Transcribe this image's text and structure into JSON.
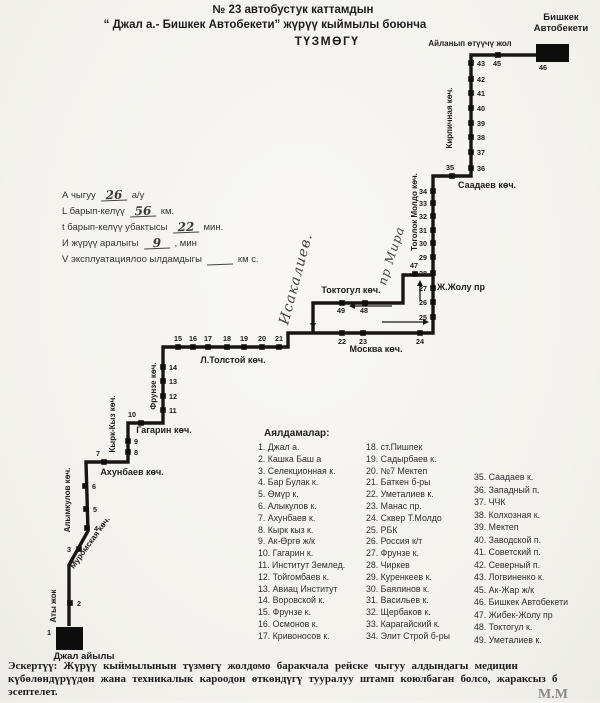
{
  "title": {
    "line1": "№ 23  автобустук каттамдын",
    "line2": "“ Джал а.- Бишкек Автобекети” жүрүү кыймылы боюнча",
    "line3": "ТҮЗМӨГҮ"
  },
  "params": {
    "rows": [
      {
        "label": "А чыгуу",
        "value": "26",
        "unit": "а/у"
      },
      {
        "label": "L барып-келүү",
        "value": "56",
        "unit": "км."
      },
      {
        "label": "t барып-келүү убактысы",
        "value": "22",
        "unit": "мин."
      },
      {
        "label": "И жүрүү аралыгы",
        "value": "9",
        "unit": ", мин"
      },
      {
        "label": "V эксплуатациялоо ылдамдыгы",
        "value": "",
        "unit": "км с."
      }
    ]
  },
  "map": {
    "line_color": "#181512",
    "routes": [
      [
        [
          69,
          626
        ],
        [
          69,
          565
        ],
        [
          88,
          531
        ],
        [
          86,
          462
        ],
        [
          128,
          462
        ],
        [
          128,
          423
        ],
        [
          163,
          423
        ],
        [
          163,
          347
        ],
        [
          288,
          347
        ],
        [
          288,
          333
        ],
        [
          433,
          333
        ],
        [
          433,
          176
        ],
        [
          471,
          176
        ],
        [
          471,
          55
        ],
        [
          537,
          55
        ]
      ],
      [
        [
          313,
          333
        ],
        [
          313,
          303
        ],
        [
          403,
          303
        ],
        [
          403,
          275
        ],
        [
          433,
          275
        ]
      ]
    ],
    "terminals": [
      {
        "name": "bishkek-terminal",
        "x": 536,
        "y": 44,
        "w": 33,
        "h": 18,
        "label_lines": [
          "Бишкек",
          "Автобекети"
        ],
        "lx": 561,
        "ly": 20,
        "dy": 11
      },
      {
        "name": "jal-terminal",
        "x": 56,
        "y": 627,
        "w": 27,
        "h": 23,
        "label_lines": [
          "Джал айылы"
        ],
        "lx": 84,
        "ly": 659,
        "dy": 11
      }
    ],
    "streets": [
      {
        "text": "Айланып өтүүчү жол",
        "x": 470,
        "y": 46,
        "rot": 0,
        "size": 8,
        "hand": false
      },
      {
        "text": "Кирпичная көч.",
        "x": 452,
        "y": 118,
        "rot": -90,
        "size": 8,
        "hand": false
      },
      {
        "text": "Саадаев көч.",
        "x": 487,
        "y": 188,
        "rot": 0,
        "size": 9,
        "hand": false
      },
      {
        "text": "Тоголок Молдо көч.",
        "x": 417,
        "y": 212,
        "rot": -90,
        "size": 8,
        "hand": false
      },
      {
        "text": "пр Мира",
        "x": 395,
        "y": 257,
        "rot": -72,
        "size": 12,
        "hand": true
      },
      {
        "text": "Исакалиев.",
        "x": 300,
        "y": 280,
        "rot": -75,
        "size": 14,
        "hand": true
      },
      {
        "text": "Ж.Жолу пр",
        "x": 461,
        "y": 290,
        "rot": 0,
        "size": 9,
        "hand": false
      },
      {
        "text": "Токтогул көч.",
        "x": 351,
        "y": 293,
        "rot": 0,
        "size": 9,
        "hand": false
      },
      {
        "text": "Москва көч.",
        "x": 376,
        "y": 352,
        "rot": 0,
        "size": 9,
        "hand": false
      },
      {
        "text": "Л.Толстой көч.",
        "x": 233,
        "y": 363,
        "rot": 0,
        "size": 9,
        "hand": false
      },
      {
        "text": "Фрунзе көч.",
        "x": 156,
        "y": 386,
        "rot": -90,
        "size": 8,
        "hand": false
      },
      {
        "text": "Гагарин көч.",
        "x": 164,
        "y": 433,
        "rot": 0,
        "size": 9,
        "hand": false
      },
      {
        "text": "Кырк-Кыз көч.",
        "x": 115,
        "y": 424,
        "rot": -90,
        "size": 8,
        "hand": false
      },
      {
        "text": "Ахунбаев көч.",
        "x": 132,
        "y": 475,
        "rot": 0,
        "size": 9,
        "hand": false
      },
      {
        "text": "Алымкулов көч.",
        "x": 70,
        "y": 500,
        "rot": -90,
        "size": 8,
        "hand": false
      },
      {
        "text": "Муромская көч.",
        "x": 92,
        "y": 544,
        "rot": -54,
        "size": 8,
        "hand": false
      },
      {
        "text": "Аты жок",
        "x": 56,
        "y": 606,
        "rot": -90,
        "size": 8,
        "hand": false
      }
    ],
    "stops": [
      {
        "n": "1",
        "x": 52,
        "y": 632,
        "lx": 49,
        "ly": 635,
        "a": "middle",
        "t": 0
      },
      {
        "n": "2",
        "x": 70,
        "y": 603,
        "lx": 77,
        "ly": 606,
        "a": "start",
        "t": 1
      },
      {
        "n": "3",
        "x": 79,
        "y": 549,
        "lx": 71,
        "ly": 552,
        "a": "end",
        "t": 1
      },
      {
        "n": "4",
        "x": 87,
        "y": 528,
        "lx": 94,
        "ly": 531,
        "a": "start",
        "t": 1
      },
      {
        "n": "5",
        "x": 86,
        "y": 509,
        "lx": 93,
        "ly": 512,
        "a": "start",
        "t": 1
      },
      {
        "n": "6",
        "x": 85,
        "y": 486,
        "lx": 92,
        "ly": 489,
        "a": "start",
        "t": 1
      },
      {
        "n": "7",
        "x": 104,
        "y": 462,
        "lx": 100,
        "ly": 456,
        "a": "end",
        "t": 1
      },
      {
        "n": "8",
        "x": 128,
        "y": 452,
        "lx": 134,
        "ly": 455,
        "a": "start",
        "t": 1
      },
      {
        "n": "9",
        "x": 128,
        "y": 441,
        "lx": 134,
        "ly": 444,
        "a": "start",
        "t": 1
      },
      {
        "n": "10",
        "x": 141,
        "y": 423,
        "lx": 136,
        "ly": 417,
        "a": "end",
        "t": 1
      },
      {
        "n": "11",
        "x": 163,
        "y": 410,
        "lx": 169,
        "ly": 413,
        "a": "start",
        "t": 1
      },
      {
        "n": "12",
        "x": 163,
        "y": 396,
        "lx": 169,
        "ly": 399,
        "a": "start",
        "t": 1
      },
      {
        "n": "13",
        "x": 163,
        "y": 381,
        "lx": 169,
        "ly": 384,
        "a": "start",
        "t": 1
      },
      {
        "n": "14",
        "x": 163,
        "y": 367,
        "lx": 169,
        "ly": 370,
        "a": "start",
        "t": 1
      },
      {
        "n": "15",
        "x": 178,
        "y": 347,
        "lx": 178,
        "ly": 341,
        "a": "middle",
        "t": 1
      },
      {
        "n": "16",
        "x": 193,
        "y": 347,
        "lx": 193,
        "ly": 341,
        "a": "middle",
        "t": 1
      },
      {
        "n": "17",
        "x": 208,
        "y": 347,
        "lx": 208,
        "ly": 341,
        "a": "middle",
        "t": 1
      },
      {
        "n": "18",
        "x": 227,
        "y": 347,
        "lx": 227,
        "ly": 341,
        "a": "middle",
        "t": 1
      },
      {
        "n": "19",
        "x": 244,
        "y": 347,
        "lx": 244,
        "ly": 341,
        "a": "middle",
        "t": 1
      },
      {
        "n": "20",
        "x": 262,
        "y": 347,
        "lx": 262,
        "ly": 341,
        "a": "middle",
        "t": 1
      },
      {
        "n": "21",
        "x": 279,
        "y": 347,
        "lx": 279,
        "ly": 341,
        "a": "middle",
        "t": 1
      },
      {
        "n": "22",
        "x": 342,
        "y": 333,
        "lx": 342,
        "ly": 344,
        "a": "middle",
        "t": 1
      },
      {
        "n": "23",
        "x": 363,
        "y": 333,
        "lx": 363,
        "ly": 344,
        "a": "middle",
        "t": 1
      },
      {
        "n": "24",
        "x": 420,
        "y": 333,
        "lx": 420,
        "ly": 344,
        "a": "middle",
        "t": 1
      },
      {
        "n": "25",
        "x": 433,
        "y": 317,
        "lx": 427,
        "ly": 320,
        "a": "end",
        "t": 1
      },
      {
        "n": "26",
        "x": 433,
        "y": 302,
        "lx": 427,
        "ly": 305,
        "a": "end",
        "t": 1
      },
      {
        "n": "27",
        "x": 433,
        "y": 288,
        "lx": 427,
        "ly": 291,
        "a": "end",
        "t": 1
      },
      {
        "n": "28",
        "x": 433,
        "y": 273,
        "lx": 427,
        "ly": 276,
        "a": "end",
        "t": 1
      },
      {
        "n": "29",
        "x": 433,
        "y": 257,
        "lx": 427,
        "ly": 260,
        "a": "end",
        "t": 1
      },
      {
        "n": "30",
        "x": 433,
        "y": 243,
        "lx": 427,
        "ly": 246,
        "a": "end",
        "t": 1
      },
      {
        "n": "31",
        "x": 433,
        "y": 230,
        "lx": 427,
        "ly": 233,
        "a": "end",
        "t": 1
      },
      {
        "n": "32",
        "x": 433,
        "y": 216,
        "lx": 427,
        "ly": 219,
        "a": "end",
        "t": 1
      },
      {
        "n": "33",
        "x": 433,
        "y": 203,
        "lx": 427,
        "ly": 206,
        "a": "end",
        "t": 1
      },
      {
        "n": "34",
        "x": 433,
        "y": 191,
        "lx": 427,
        "ly": 194,
        "a": "end",
        "t": 1
      },
      {
        "n": "35",
        "x": 452,
        "y": 176,
        "lx": 450,
        "ly": 170,
        "a": "middle",
        "t": 1
      },
      {
        "n": "36",
        "x": 471,
        "y": 168,
        "lx": 477,
        "ly": 171,
        "a": "start",
        "t": 1
      },
      {
        "n": "37",
        "x": 471,
        "y": 152,
        "lx": 477,
        "ly": 155,
        "a": "start",
        "t": 1
      },
      {
        "n": "38",
        "x": 471,
        "y": 137,
        "lx": 477,
        "ly": 140,
        "a": "start",
        "t": 1
      },
      {
        "n": "39",
        "x": 471,
        "y": 123,
        "lx": 477,
        "ly": 126,
        "a": "start",
        "t": 1
      },
      {
        "n": "40",
        "x": 471,
        "y": 108,
        "lx": 477,
        "ly": 111,
        "a": "start",
        "t": 1
      },
      {
        "n": "41",
        "x": 471,
        "y": 93,
        "lx": 477,
        "ly": 96,
        "a": "start",
        "t": 1
      },
      {
        "n": "42",
        "x": 471,
        "y": 79,
        "lx": 477,
        "ly": 82,
        "a": "start",
        "t": 1
      },
      {
        "n": "43",
        "x": 471,
        "y": 63,
        "lx": 477,
        "ly": 66,
        "a": "start",
        "t": 1
      },
      {
        "n": "45",
        "x": 498,
        "y": 55,
        "lx": 497,
        "ly": 66,
        "a": "middle",
        "t": 1
      },
      {
        "n": "46",
        "x": 536,
        "y": 58,
        "lx": 543,
        "ly": 70,
        "a": "middle",
        "t": 0
      },
      {
        "n": "47",
        "x": 415,
        "y": 274,
        "lx": 414,
        "ly": 268,
        "a": "middle",
        "t": 1
      },
      {
        "n": "48",
        "x": 365,
        "y": 303,
        "lx": 364,
        "ly": 313,
        "a": "middle",
        "t": 1
      },
      {
        "n": "49",
        "x": 342,
        "y": 303,
        "lx": 341,
        "ly": 313,
        "a": "middle",
        "t": 1
      }
    ],
    "arrows": [
      {
        "x1": 392,
        "y1": 306,
        "x2": 349,
        "y2": 306
      },
      {
        "x1": 420,
        "y1": 301,
        "x2": 420,
        "y2": 280
      },
      {
        "x1": 382,
        "y1": 322,
        "x2": 429,
        "y2": 322
      },
      {
        "x1": 313,
        "y1": 307,
        "x2": 313,
        "y2": 329
      }
    ]
  },
  "legend": {
    "header": "Аялдамалар:",
    "col1": [
      "1. Джал а.",
      "2. Кашка Баш а",
      "3. Селекционная к.",
      "4. Бар Булак к.",
      "5. Өмүр к.",
      "6. Алыкулов к.",
      "7. Ахунбаев к.",
      "8. Кырк кыз к.",
      "9. Ак-Өргө ж/к",
      "10. Гагарин к.",
      "11. Институт Землед.",
      "12. Тойгомбаев к.",
      "13. Авиац Институт",
      "14. Воровской к.",
      "15. Фрунзе к.",
      "16. Осмонов к.",
      "17. Кривоносов к."
    ],
    "col2": [
      "18. ст.Пишпек",
      "19. Садырбаев к.",
      "20. №7 Мектеп",
      "21. Баткен б-ры",
      "22. Уметалиев к.",
      "23. Манас пр.",
      "24. Сквер Т.Молдо",
      "25. РБК",
      "26. Россия к/т",
      "27. Фрунзе к.",
      "28. Чиркев",
      "29. Куренкеев к.",
      "30. Баялинов к.",
      "31. Васильев к.",
      "32. Щербаков к.",
      "33. Карагайский к.",
      "34. Элит Строй б-ры"
    ],
    "col3": [
      "35. Саадаев к.",
      "36. Западный п.",
      "37. ЧЧК",
      "38. Колхозная к.",
      "39. Мектеп",
      "40. Заводской п.",
      "41. Советский п.",
      "42. Северный п.",
      "43. Логвиненко к.",
      "45. Ак-Жар ж/к",
      "46. Бишкек Автобекети",
      "47. Жибек-Жолу пр",
      "48. Токтогул к.",
      "49. Уметалиев к."
    ]
  },
  "note": {
    "prefix": "Эскертүү:",
    "lines": [
      "Жүрүү кыймылынын түзмөгү жолдомо баракчала рейске чыгуу алдындагы медицин",
      "күбөлөндүрүүдөн жана техникалык кароодон өткөндүгү тууралуу штамп коюлбаган болсо, жараксыз б",
      "эсептелет."
    ]
  },
  "signature": "М.М"
}
